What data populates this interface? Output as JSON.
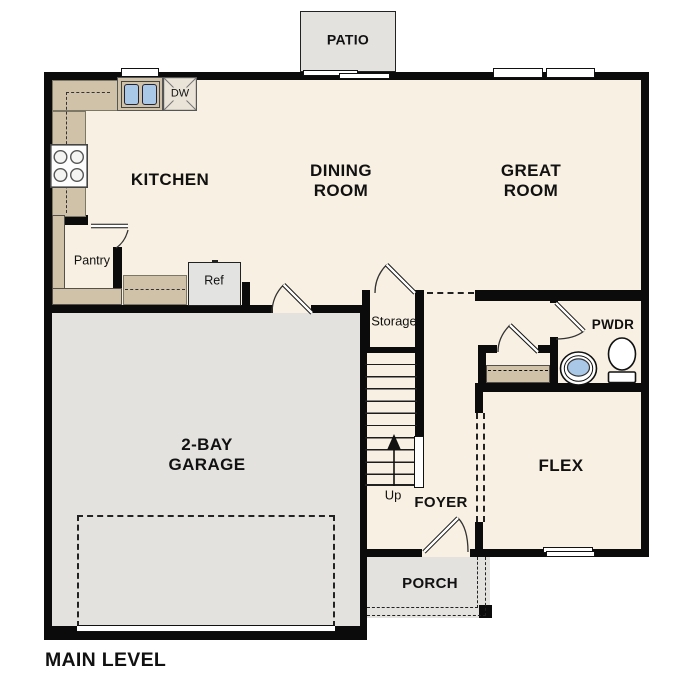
{
  "floor_plan": {
    "title": "MAIN LEVEL",
    "rooms": {
      "patio": "PATIO",
      "kitchen": "KITCHEN",
      "dining_room": [
        "DINING",
        "ROOM"
      ],
      "great_room": [
        "GREAT",
        "ROOM"
      ],
      "pantry": "Pantry",
      "storage": "Storage",
      "powder_room": "PWDR",
      "garage": [
        "2-BAY",
        "GARAGE"
      ],
      "flex": "FLEX",
      "foyer": "FOYER",
      "porch": "PORCH"
    },
    "fixtures": {
      "dishwasher": "DW",
      "refrigerator": "Ref",
      "stairs_direction": "Up"
    },
    "colors": {
      "floor": "#f8f0e2",
      "hardscape": "#e4e2df",
      "casework": "#cfc2a9",
      "water": "#a9c7e6",
      "wall": "#0b0b0b"
    }
  }
}
